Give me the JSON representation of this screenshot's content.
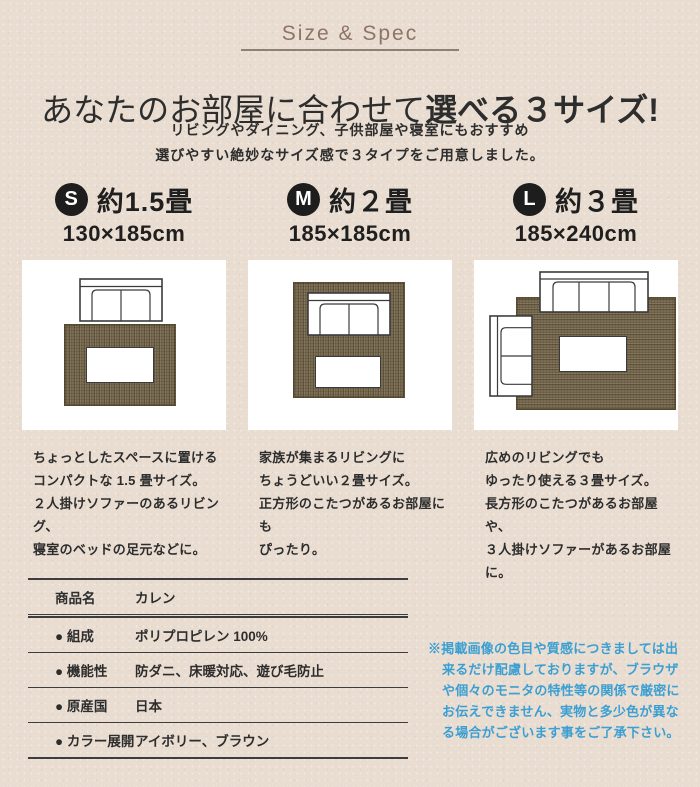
{
  "header": {
    "section_label": "Size & Spec",
    "title_normal": "あなたのお部屋に合わせて",
    "title_bold": "選べる３サイズ!",
    "subtitle_line1": "リビングやダイニング、子供部屋や寝室にもおすすめ",
    "subtitle_line2": "選びやすい絶妙なサイズ感で３タイプをご用意しました。"
  },
  "cards": [
    {
      "badge": "S",
      "size_label": "約1.5畳",
      "dimensions": "130×185cm",
      "desc_lines": [
        "ちょっとしたスペースに置ける",
        "コンパクトな 1.5 畳サイズ。",
        "２人掛けソファーのあるリビング、",
        "寝室のベッドの足元などに。"
      ]
    },
    {
      "badge": "M",
      "size_label": "約２畳",
      "dimensions": "185×185cm",
      "desc_lines": [
        "家族が集まるリビングに",
        "ちょうどいい２畳サイズ。",
        "正方形のこたつがあるお部屋にも",
        "ぴったり。"
      ]
    },
    {
      "badge": "L",
      "size_label": "約３畳",
      "dimensions": "185×240cm",
      "desc_lines": [
        "広めのリビングでも",
        "ゆったり使える３畳サイズ。",
        "長方形のこたつがあるお部屋や、",
        "３人掛けソファーがあるお部屋に。"
      ]
    }
  ],
  "spec_table": {
    "rows": [
      {
        "label": "商品名",
        "value": "カレン"
      },
      {
        "label": "● 組成",
        "value": "ポリプロピレン 100%"
      },
      {
        "label": "● 機能性",
        "value": "防ダニ、床暖対応、遊び毛防止"
      },
      {
        "label": "● 原産国",
        "value": "日本"
      },
      {
        "label": "● カラー展開",
        "value": "アイボリー、ブラウン"
      }
    ]
  },
  "disclaimer": "※掲載画像の色目や質感につきましては出来るだけ配慮しておりますが、ブラウザや個々のモニタの特性等の関係で厳密にお伝えできません、実物と多少色が異なる場合がございます事をご了承下さい。",
  "colors": {
    "background": "#e9ddd1",
    "accent_blue": "#3b9fd2",
    "rug_brown": "#7a6c52",
    "badge_black": "#1d1d1d",
    "section_label_brown": "#8e7466"
  }
}
